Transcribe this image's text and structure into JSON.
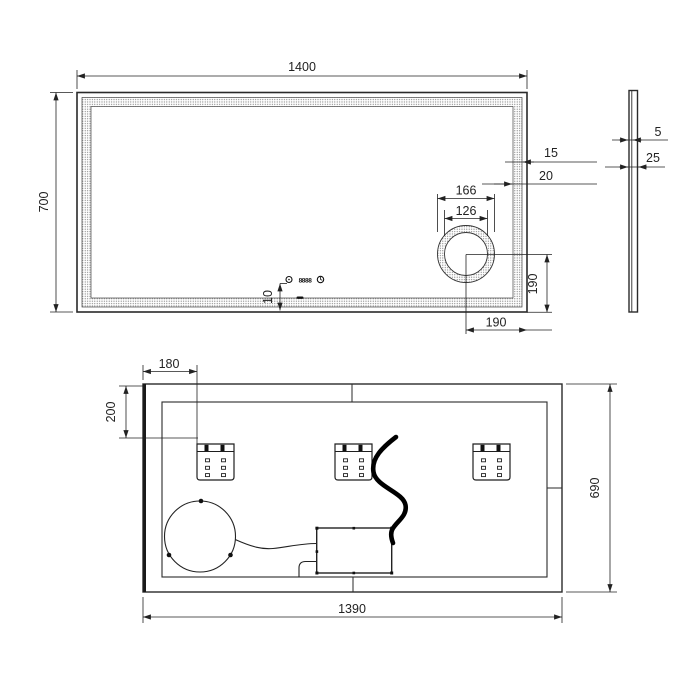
{
  "drawing_type": "technical-dimension-drawing",
  "product": "led-mirror",
  "views": {
    "front": {
      "dims": {
        "width": "1400",
        "height": "700",
        "led_inset_inner": "15",
        "led_inset_outer": "20",
        "magnifier_outer_d": "166",
        "magnifier_inner_d": "126",
        "magnifier_to_bottom": "190",
        "magnifier_to_right": "190",
        "touch_to_edge": "10"
      },
      "display_text": "8888",
      "icons": [
        "power-icon",
        "clock-icon",
        "touch-button-dash"
      ]
    },
    "side": {
      "dims": {
        "glass_thickness": "5",
        "total_depth": "25"
      }
    },
    "back": {
      "dims": {
        "bracket_from_left": "180",
        "bracket_from_top": "200",
        "height": "690",
        "width": "1390"
      },
      "parts": [
        "mounting-bracket",
        "mounting-bracket",
        "mounting-bracket",
        "magnifier-housing-back",
        "driver-box",
        "power-cable"
      ]
    }
  },
  "colors": {
    "line": "#2a2a2a",
    "stipple": "#666",
    "cable": "#000000",
    "background": "#ffffff"
  }
}
